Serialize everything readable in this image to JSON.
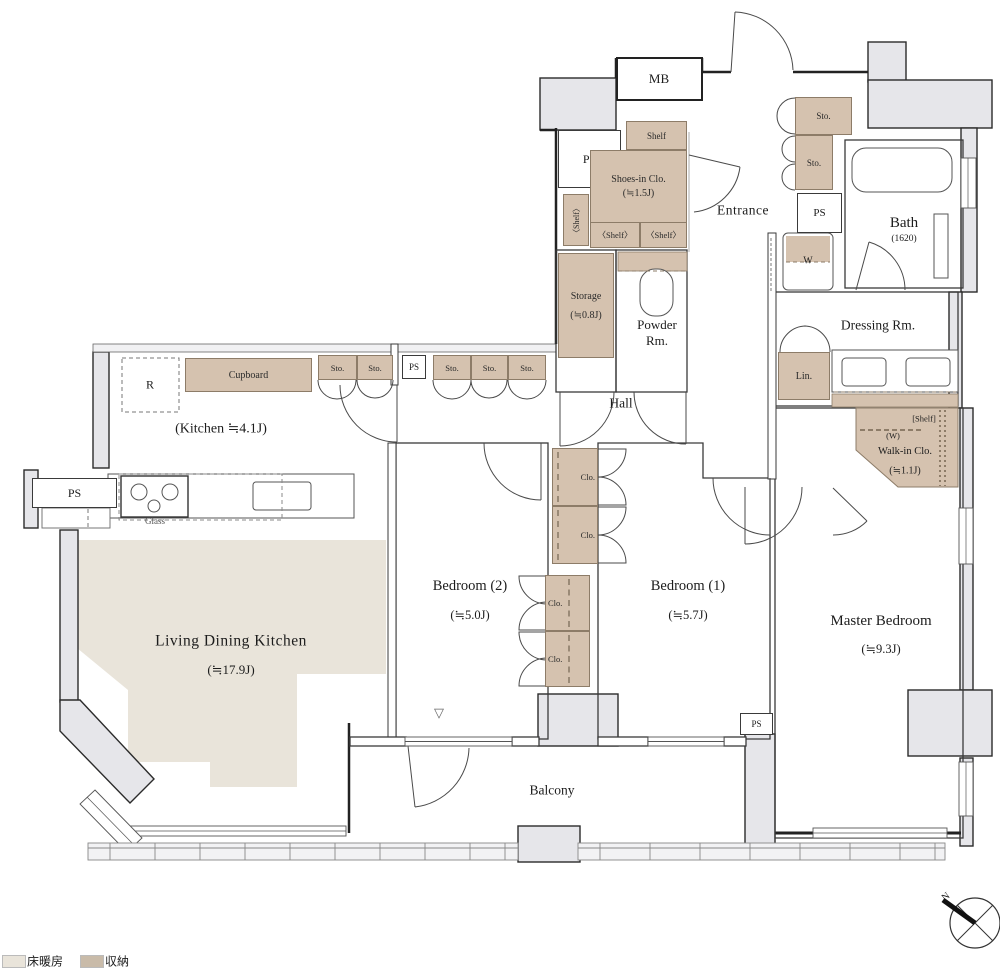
{
  "rooms": {
    "ldk": {
      "name": "Living Dining Kitchen",
      "size": "(≒17.9J)"
    },
    "kitchen": {
      "label": "(Kitchen  ≒4.1J)"
    },
    "bedroom2": {
      "name": "Bedroom (2)",
      "size": "(≒5.0J)"
    },
    "bedroom1": {
      "name": "Bedroom (1)",
      "size": "(≒5.7J)"
    },
    "master": {
      "name": "Master Bedroom",
      "size": "(≒9.3J)"
    },
    "bath": {
      "name": "Bath",
      "size": "(1620)"
    },
    "dressing": {
      "name": "Dressing Rm."
    },
    "powder": {
      "line1": "Powder",
      "line2": "Rm."
    },
    "storage": {
      "name": "Storage",
      "size": "(≒0.8J)"
    },
    "shoes": {
      "name": "Shoes-in Clo.",
      "size": "(≒1.5J)"
    },
    "walkin": {
      "name": "Walk-in Clo.",
      "size": "(≒1.1J)",
      "shelf": "[Shelf]",
      "w": "(W)"
    },
    "entrance": {
      "name": "Entrance"
    },
    "hall": {
      "name": "Hall"
    },
    "balcony": {
      "name": "Balcony"
    }
  },
  "labels": {
    "mb": "MB",
    "ps": "PS",
    "sto": "Sto.",
    "clo": "Clo.",
    "shelf": "Shelf",
    "shelf_bracket": "〈Shelf〉",
    "lin": "Lin.",
    "w": "W",
    "r": "R",
    "cupboard": "Cupboard",
    "glass": "Glass",
    "step_marker": "▽"
  },
  "legend": {
    "floor_heating": "床暖房",
    "storage": "収納"
  },
  "compass": {
    "north": "N"
  },
  "colors": {
    "storage_fill": "#d5c2af",
    "floor_heating_fill": "#e9e4da",
    "wall_fill": "#e6e6ea",
    "legend_storage": "#c9bba9"
  }
}
